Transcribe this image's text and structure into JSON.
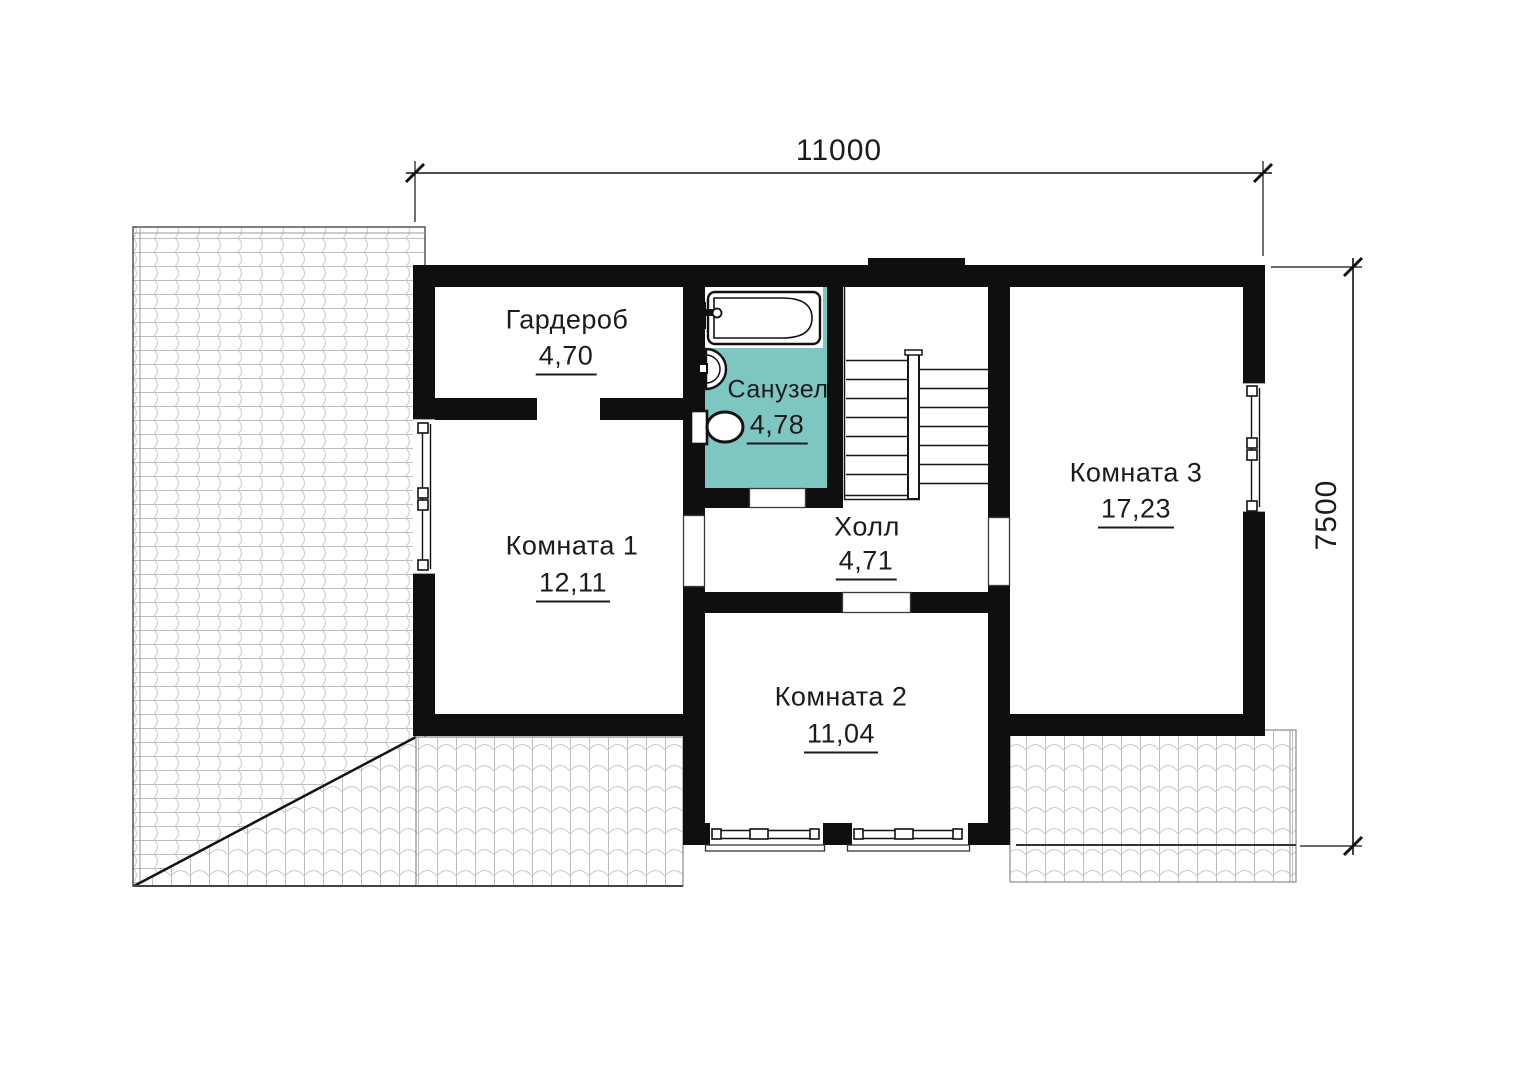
{
  "title": "Floor plan — second level",
  "dimensions": {
    "width_mm": "11000",
    "height_mm": "7500"
  },
  "rooms": [
    {
      "name": "Гардероб",
      "area": "4,70"
    },
    {
      "name": "Санузел",
      "area": "4,78"
    },
    {
      "name": "Комната 1",
      "area": "12,11"
    },
    {
      "name": "Холл",
      "area": "4,71"
    },
    {
      "name": "Комната 2",
      "area": "11,04"
    },
    {
      "name": "Комната 3",
      "area": "17,23"
    }
  ],
  "fixtures": [
    "bathtub",
    "sink",
    "toilet",
    "staircase"
  ],
  "colors": {
    "wall": "#0f0f0f",
    "bathroom_fill": "#7ec6c2",
    "roof_line": "#c3c3c3",
    "text": "#1b1b1b"
  }
}
